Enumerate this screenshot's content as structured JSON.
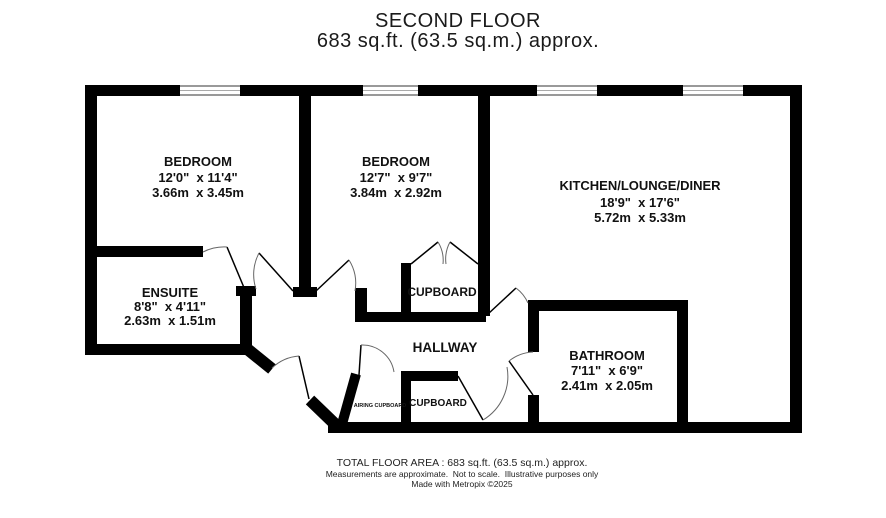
{
  "title": {
    "line1": "SECOND FLOOR",
    "line2": "683 sq.ft. (63.5 sq.m.) approx."
  },
  "rooms": {
    "bedroom1": {
      "name": "BEDROOM",
      "imperial": "12'0\"  x 11'4\"",
      "metric": "3.66m  x 3.45m"
    },
    "bedroom2": {
      "name": "BEDROOM",
      "imperial": "12'7\"  x 9'7\"",
      "metric": "3.84m  x 2.92m"
    },
    "kitchen": {
      "name": "KITCHEN/LOUNGE/DINER",
      "imperial": "18'9\"  x 17'6\"",
      "metric": "5.72m  x 5.33m"
    },
    "ensuite": {
      "name": "ENSUITE",
      "imperial": "8'8\"  x 4'11\"",
      "metric": "2.63m  x 1.51m"
    },
    "bathroom": {
      "name": "BATHROOM",
      "imperial": "7'11\"  x 6'9\"",
      "metric": "2.41m  x 2.05m"
    },
    "cupboard_bedroom": {
      "name": "CUPBOARD"
    },
    "hallway": {
      "name": "HALLWAY"
    },
    "airing_cupboard": {
      "name": "AIRING CUPBOARD"
    },
    "cupboard_hall": {
      "name": "CUPBOARD"
    }
  },
  "footer": {
    "line1": "TOTAL FLOOR AREA : 683 sq.ft. (63.5 sq.m.) approx.",
    "line2": "Measurements are approximate.  Not to scale.  Illustrative purposes only",
    "line3": "Made with Metropix ©2025"
  },
  "colors": {
    "wall": "#000000",
    "background": "#ffffff",
    "text": "#111111"
  }
}
